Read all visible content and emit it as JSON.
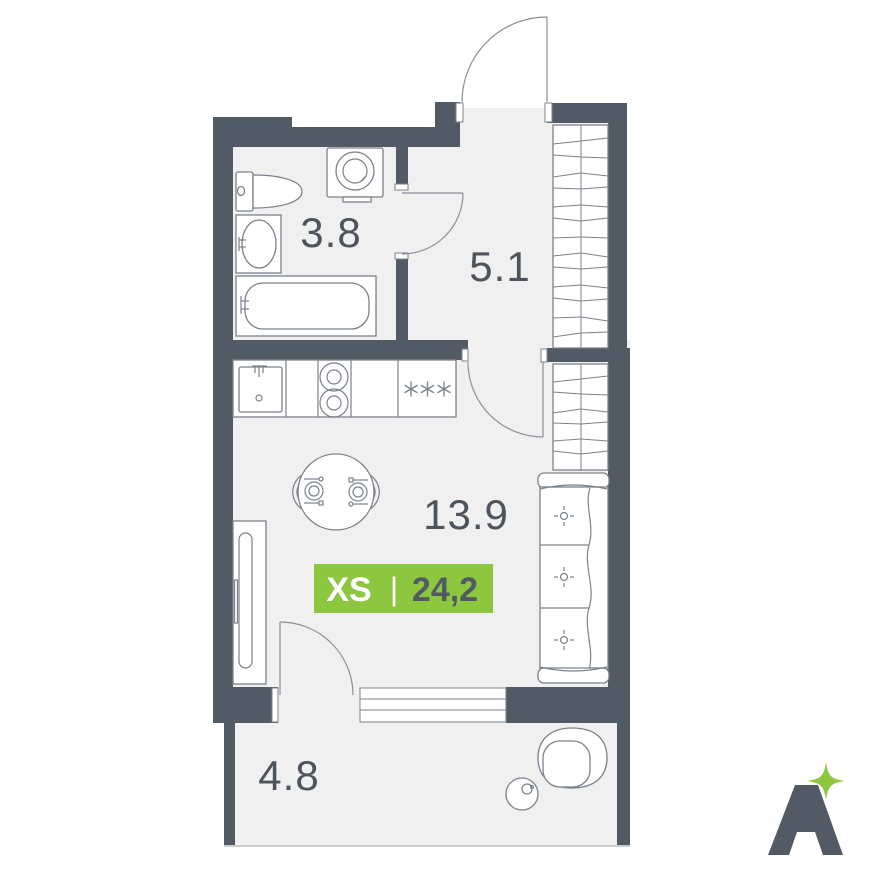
{
  "plan": {
    "rooms": [
      {
        "id": "bathroom",
        "area_label": "3.8"
      },
      {
        "id": "hall",
        "area_label": "5.1"
      },
      {
        "id": "living",
        "area_label": "13.9"
      },
      {
        "id": "balcony",
        "area_label": "4.8"
      }
    ],
    "badge": {
      "type_label": "XS",
      "divider": "|",
      "total_area": "24,2",
      "bg_color": "#8dc63f",
      "type_color": "#ffffff",
      "area_color": "#525b65"
    },
    "fridge_symbol": "***",
    "colors": {
      "wall": "#525b65",
      "floor": "#f0f0f1",
      "furniture_line": "#7b828b",
      "label": "#4d545c",
      "accent_green": "#8dc63f"
    },
    "icons": {
      "toilet": "toilet-icon",
      "washbasin": "washbasin-icon",
      "bathtub": "bathtub-icon",
      "washing_machine": "washing-machine-icon",
      "kitchen_sink": "kitchen-sink-icon",
      "stove": "stove-two-burner-icon",
      "fridge": "fridge-asterisks-icon",
      "dining_table": "dining-table-icon",
      "wardrobe": "wardrobe-hatch-icon",
      "sofa": "sofa-icon",
      "armchair": "armchair-icon"
    }
  },
  "logo": {
    "letter": "A",
    "letter_color": "#525b65",
    "sparkle_color": "#8dc63f"
  }
}
